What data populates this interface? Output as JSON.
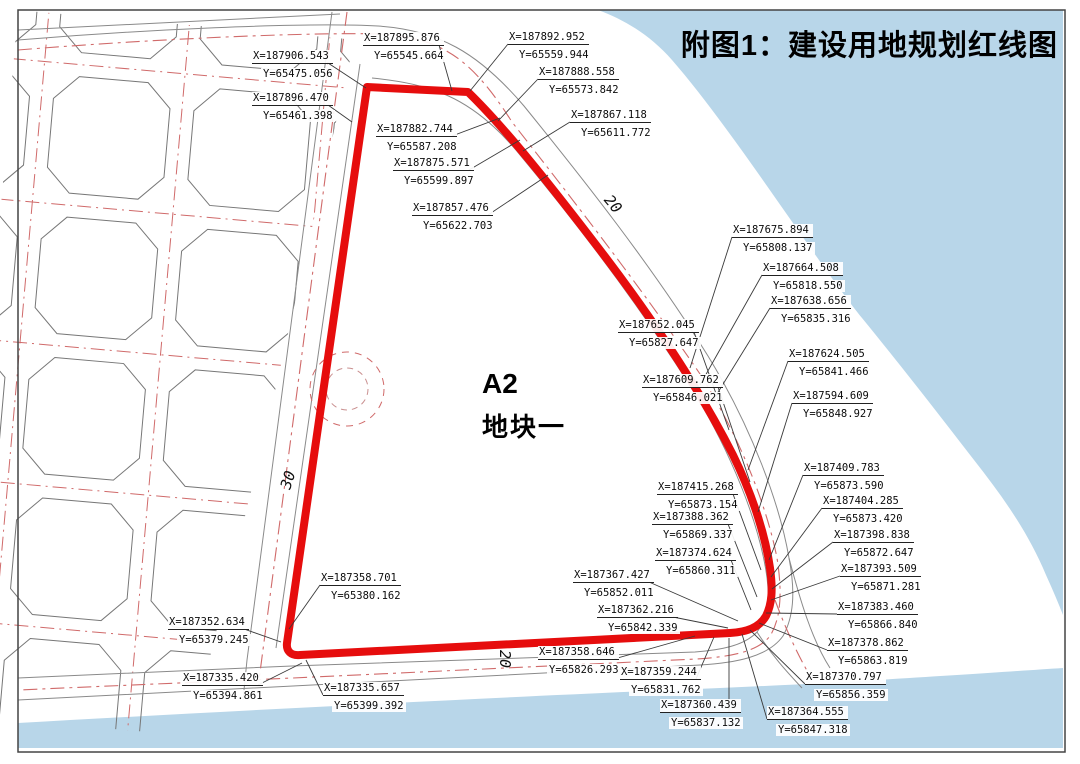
{
  "title": "附图1：建设用地规划红线图",
  "plot": {
    "code": "A2",
    "name": "地块一"
  },
  "road_width_labels": [
    {
      "text": "30",
      "x": 288,
      "y": 480,
      "rotation": -72
    },
    {
      "text": "20",
      "x": 613,
      "y": 204,
      "rotation": 50
    },
    {
      "text": "20",
      "x": 505,
      "y": 659,
      "rotation": 90
    }
  ],
  "colors": {
    "water": "#b8d6e9",
    "redline": "#e60d0d",
    "centerline": "#d06a6a",
    "road_line": "#8a8a8a",
    "parcel_line": "#777777",
    "leader": "#3a3a3a",
    "frame": "#444444",
    "text": "#0b0b0b"
  },
  "coordinate_points": [
    {
      "x_label": "X=187906.543",
      "y_label": "Y=65475.056",
      "left": 252,
      "top": 50,
      "tx": 366,
      "ty": 88
    },
    {
      "x_label": "X=187895.876",
      "y_label": "Y=65545.664",
      "left": 363,
      "top": 32,
      "tx": 452,
      "ty": 91
    },
    {
      "x_label": "X=187892.952",
      "y_label": "Y=65559.944",
      "left": 508,
      "top": 31,
      "tx": 470,
      "ty": 91
    },
    {
      "x_label": "X=187888.558",
      "y_label": "Y=65573.842",
      "left": 538,
      "top": 66,
      "tx": 498,
      "ty": 121
    },
    {
      "x_label": "X=187867.118",
      "y_label": "Y=65611.772",
      "left": 570,
      "top": 109,
      "tx": 523,
      "ty": 151
    },
    {
      "x_label": "X=187896.470",
      "y_label": "Y=65461.398",
      "left": 252,
      "top": 92,
      "tx": 352,
      "ty": 122
    },
    {
      "x_label": "X=187882.744",
      "y_label": "Y=65587.208",
      "left": 376,
      "top": 123,
      "tx": 500,
      "ty": 118
    },
    {
      "x_label": "X=187875.571",
      "y_label": "Y=65599.897",
      "left": 393,
      "top": 157,
      "tx": 520,
      "ty": 140
    },
    {
      "x_label": "X=187857.476",
      "y_label": "Y=65622.703",
      "left": 412,
      "top": 202,
      "tx": 548,
      "ty": 175
    },
    {
      "x_label": "X=187675.894",
      "y_label": "Y=65808.137",
      "left": 732,
      "top": 224,
      "tx": 690,
      "ty": 368
    },
    {
      "x_label": "X=187664.508",
      "y_label": "Y=65818.550",
      "left": 762,
      "top": 262,
      "tx": 700,
      "ty": 385
    },
    {
      "x_label": "X=187638.656",
      "y_label": "Y=65835.316",
      "left": 770,
      "top": 295,
      "tx": 712,
      "ty": 402
    },
    {
      "x_label": "X=187652.045",
      "y_label": "Y=65827.647",
      "left": 618,
      "top": 319,
      "tx": 729,
      "ty": 430
    },
    {
      "x_label": "X=187624.505",
      "y_label": "Y=65841.466",
      "left": 788,
      "top": 348,
      "tx": 748,
      "ty": 470
    },
    {
      "x_label": "X=187609.762",
      "y_label": "Y=65846.021",
      "left": 642,
      "top": 374,
      "tx": 750,
      "ty": 482
    },
    {
      "x_label": "X=187594.609",
      "y_label": "Y=65848.927",
      "left": 792,
      "top": 390,
      "tx": 758,
      "ty": 512
    },
    {
      "x_label": "X=187409.783",
      "y_label": "Y=65873.590",
      "left": 803,
      "top": 462,
      "tx": 769,
      "ty": 560
    },
    {
      "x_label": "X=187404.285",
      "y_label": "Y=65873.420",
      "left": 822,
      "top": 495,
      "tx": 771,
      "ty": 577
    },
    {
      "x_label": "X=187398.838",
      "y_label": "Y=65872.647",
      "left": 833,
      "top": 529,
      "tx": 772,
      "ty": 589
    },
    {
      "x_label": "X=187393.509",
      "y_label": "Y=65871.281",
      "left": 840,
      "top": 563,
      "tx": 771,
      "ty": 600
    },
    {
      "x_label": "X=187383.460",
      "y_label": "Y=65866.840",
      "left": 837,
      "top": 601,
      "tx": 766,
      "ty": 613
    },
    {
      "x_label": "X=187378.862",
      "y_label": "Y=65863.819",
      "left": 827,
      "top": 637,
      "tx": 759,
      "ty": 623
    },
    {
      "x_label": "X=187370.797",
      "y_label": "Y=65856.359",
      "left": 805,
      "top": 671,
      "tx": 750,
      "ty": 630
    },
    {
      "x_label": "X=187364.555",
      "y_label": "Y=65847.318",
      "left": 767,
      "top": 706,
      "tx": 742,
      "ty": 634
    },
    {
      "x_label": "X=187415.268",
      "y_label": "Y=65873.154",
      "left": 657,
      "top": 481,
      "tx": 761,
      "ty": 570
    },
    {
      "x_label": "X=187388.362",
      "y_label": "Y=65869.337",
      "left": 652,
      "top": 511,
      "tx": 757,
      "ty": 597
    },
    {
      "x_label": "X=187374.624",
      "y_label": "Y=65860.311",
      "left": 655,
      "top": 547,
      "tx": 751,
      "ty": 610
    },
    {
      "x_label": "X=187367.427",
      "y_label": "Y=65852.011",
      "left": 573,
      "top": 569,
      "tx": 738,
      "ty": 621
    },
    {
      "x_label": "X=187362.216",
      "y_label": "Y=65842.339",
      "left": 597,
      "top": 604,
      "tx": 728,
      "ty": 628
    },
    {
      "x_label": "X=187358.646",
      "y_label": "Y=65826.293",
      "left": 538,
      "top": 646,
      "tx": 695,
      "ty": 636
    },
    {
      "x_label": "X=187359.244",
      "y_label": "Y=65831.762",
      "left": 620,
      "top": 666,
      "tx": 714,
      "ty": 637
    },
    {
      "x_label": "X=187360.439",
      "y_label": "Y=65837.132",
      "left": 660,
      "top": 699,
      "tx": 729,
      "ty": 638
    },
    {
      "x_label": "X=187358.701",
      "y_label": "Y=65380.162",
      "left": 320,
      "top": 572,
      "tx": 289,
      "ty": 629
    },
    {
      "x_label": "X=187352.634",
      "y_label": "Y=65379.245",
      "left": 168,
      "top": 616,
      "tx": 281,
      "ty": 642
    },
    {
      "x_label": "X=187335.420",
      "y_label": "Y=65394.861",
      "left": 182,
      "top": 672,
      "tx": 302,
      "ty": 663
    },
    {
      "x_label": "X=187335.657",
      "y_label": "Y=65399.392",
      "left": 323,
      "top": 682,
      "tx": 306,
      "ty": 660
    }
  ]
}
